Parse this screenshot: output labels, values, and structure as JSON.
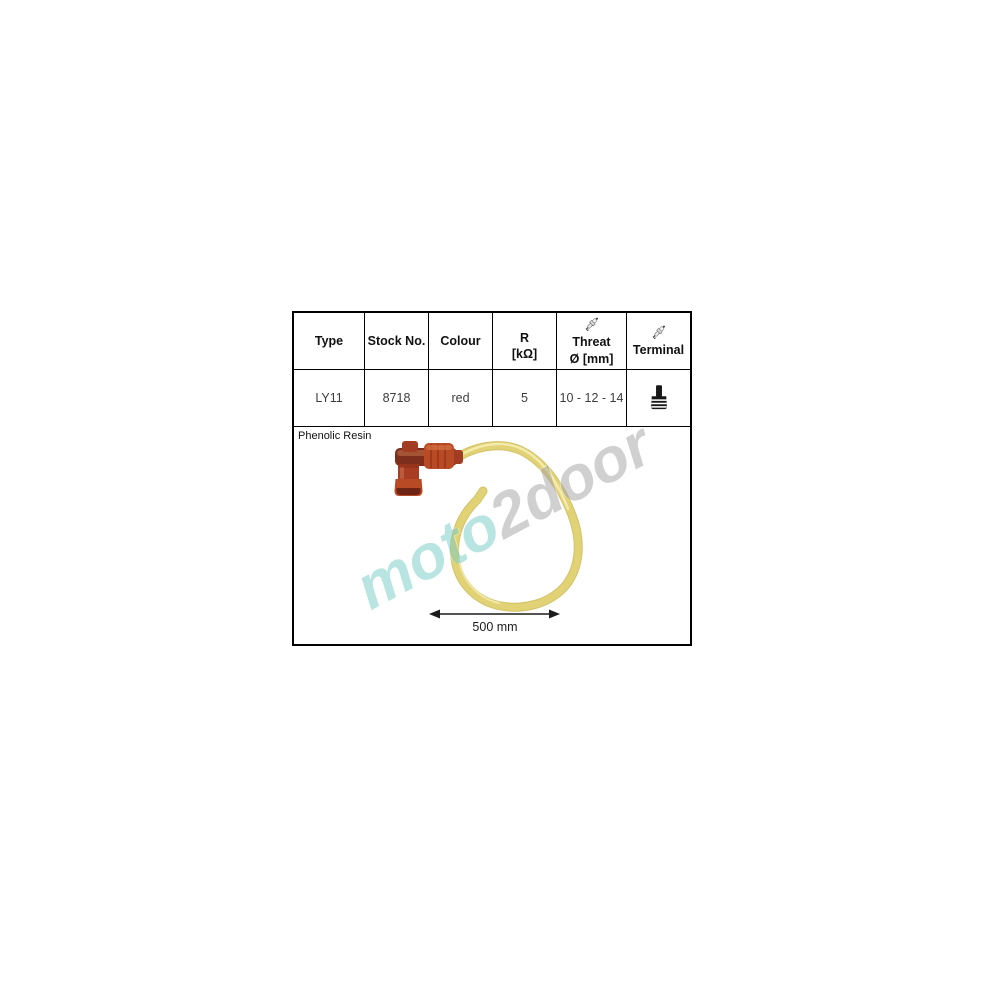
{
  "table": {
    "columns": [
      {
        "label": "Type"
      },
      {
        "label": "Stock No."
      },
      {
        "label": "Colour"
      },
      {
        "label": "R",
        "label2": "[kΩ]"
      },
      {
        "label": "Threat",
        "label2": "Ø [mm]",
        "icon": "spark-plug-icon"
      },
      {
        "label": "Terminal",
        "icon": "spark-plug-icon"
      }
    ],
    "row": {
      "type": "LY11",
      "stock_no": "8718",
      "colour": "red",
      "r": "5",
      "threat": "10 - 12 - 14",
      "terminal_icon": "terminal-stud-icon"
    }
  },
  "material_note": "Phenolic Resin",
  "figure": {
    "dimension_label": "500 mm",
    "subject": "red 90-degree spark plug cap with yellow ignition wire coiled in a loop"
  },
  "watermark": {
    "part1": "moto",
    "part2": "2door"
  },
  "colors": {
    "watermark_teal": "#74ccc4",
    "watermark_gray": "#a2a2a2",
    "cap_red": "#b84a26",
    "cap_dark": "#7e2e1c",
    "wire_yellow": "#e2d276",
    "wire_highlight": "#f3ecae",
    "table_border": "#000000"
  }
}
